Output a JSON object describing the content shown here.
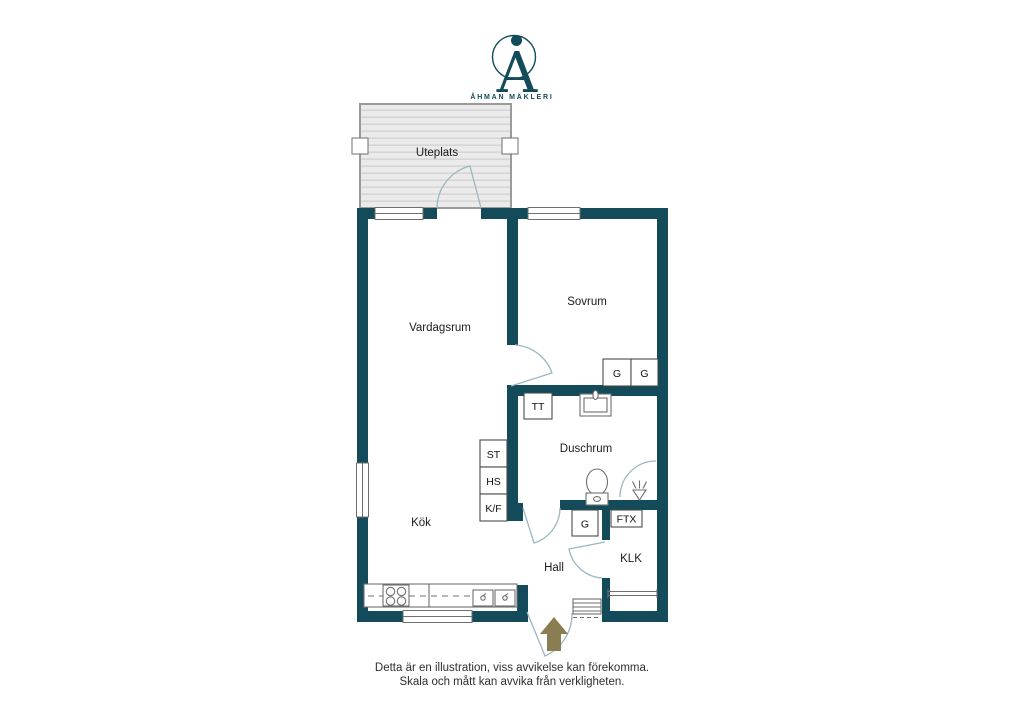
{
  "brand": {
    "name": "ÅHMAN MÄKLERI",
    "monogram_letter": "A"
  },
  "rooms": {
    "uteplats": "Uteplats",
    "vardagsrum": "Vardagsrum",
    "sovrum": "Sovrum",
    "duschrum": "Duschrum",
    "kok": "Kök",
    "hall": "Hall",
    "klk": "KLK"
  },
  "fixtures": {
    "tt": "TT",
    "g_sovrum_1": "G",
    "g_sovrum_2": "G",
    "st": "ST",
    "hs": "HS",
    "kf": "K/F",
    "g_hall": "G",
    "ftx": "FTX"
  },
  "footer": {
    "line1": "Detta är en illustration, viss avvikelse kan förekomma.",
    "line2": "Skala och mått kan avvika från verkligheten."
  },
  "colors": {
    "wall": "#134b5a",
    "door_arc": "#9bb7c1",
    "brand": "#134b5a",
    "arrow": "#8b7d52",
    "patio_fill": "#ebebeb",
    "patio_stripe": "#d6d6d6",
    "fixture": "#6f6f6f",
    "label_text": "#1c1c1c",
    "footer_text": "#2e2e2e"
  }
}
